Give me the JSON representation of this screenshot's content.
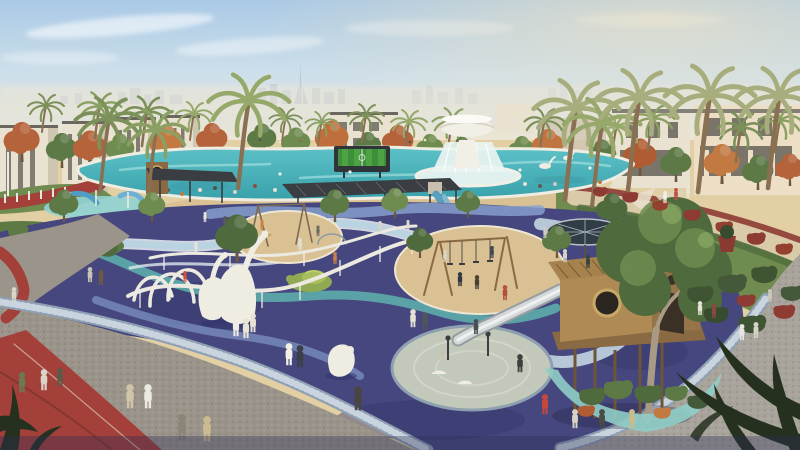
{
  "meta": {
    "kind": "architectural-rendering",
    "label": "Aerial rendering of a landscaped community park with playground, lagoon pool and fountain"
  },
  "labels": {
    "scene": "Community park rendering",
    "sky": "Hazy warm sky with wispy clouds",
    "skyline": "Distant hazy city skyline",
    "tower": "Burj Khalifa silhouette",
    "villas_left": "White townhouse villas, left row",
    "villas_right": "Cream villa facades, right row",
    "fountain": "White tulip fountain with cascading water",
    "pool": "Lagoon swimming pool",
    "screen": "Outdoor video screen showing green sports field",
    "splash": "Kids aqua splash area with blue slides",
    "plaza": "Granite cobble plaza",
    "track": "Red running track",
    "playground": "Indigo rubber playground surface with wavy ribbons",
    "swans": "White swan play sculptures with looping rails",
    "sand_small": "Sand play circle with climbing frames",
    "sand_large": "Sand play area with swing sets",
    "pergola_left": "Dark shade canopy with porthole tower",
    "pergola_center": "Long shade pergola",
    "umbrella": "Large ribbed shade umbrella",
    "pad": "Pale circular play pad",
    "slide": "Gray slide from treehouse",
    "treehouse": "Wooden treehouse on stilts with porthole",
    "tree_big": "Large tree growing through treehouse",
    "crescent": "Teal crescent path around planting island",
    "cobble_right": "Curved cobblestone promenade",
    "walkway": "Curved walkway with red flower hedge",
    "bear": "White bear play sculpture",
    "turtle": "Green turtle play mound",
    "palm_silhouette": "Dark palm fronds in foreground corner",
    "people": "Park visitors",
    "palms": "Palm trees"
  },
  "palette": {
    "sky_top": "#a9c9e6",
    "sky_mid": "#cfe0ea",
    "horizon": "#ece5d4",
    "glow": "#f6e3bd",
    "skyline": "#b6c2d0",
    "bldg_light": "#e9e2d1",
    "bldg_shade": "#cfc6b2",
    "bldg_dark": "#55514a",
    "tree_green": "#5d7a46",
    "tree_green2": "#6f8c50",
    "tree_dark": "#4f6a3c",
    "orange": "#b5633a",
    "orange2": "#c27a42",
    "palm": "#7c915a",
    "palm2": "#96a86a",
    "palm3": "#a8ad7e",
    "pool": "#5cc0c6",
    "pool_deep": "#3aa2ac",
    "water_light": "#dff0ee",
    "fountain": "#f2efe6",
    "sand": "#d9c194",
    "sand_light": "#e2cfa4",
    "walk": "#d9cba8",
    "lawn": "#6f8b4f",
    "lawn_dark": "#5e7a44",
    "plaza": "#9b948a",
    "cobble": "#a8a49c",
    "mosaic": "#8fa0b4",
    "mosaic_light": "#c9d4de",
    "track": "#a3403a",
    "track_dark": "#7e332e",
    "play": "#45477e",
    "play_dark": "#32356a",
    "play_deep": "#2c2f55",
    "ribbon_pale": "#c2d6e2",
    "ribbon_teal": "#5fb3ae",
    "ribbon_peri": "#8aa4cf",
    "ribbon_light": "#b9d4e0",
    "wood": "#b08a55",
    "wood_dark": "#8a6a42",
    "wood_deep": "#6e5536",
    "pad": "#c2c9ba",
    "crescent": "#8fcdc7",
    "slide": "#d4d8d9",
    "struct": "#3a3e42",
    "silhouette": "#26301f",
    "white": "#efece2",
    "hedge": "#8e3b34",
    "hedge_green": "#516d3d",
    "screen_green": "#3f8f3a"
  },
  "sprites": {
    "palms": [
      [
        42,
        132,
        1.0,
        "#7c915a"
      ],
      [
        95,
        138,
        1.2,
        "#8aa062"
      ],
      [
        142,
        146,
        1.3,
        "#7c915a"
      ],
      [
        190,
        140,
        1.0,
        "#96a86a"
      ],
      [
        282,
        142,
        0.9,
        "#7c915a"
      ],
      [
        318,
        146,
        0.9,
        "#8aa062"
      ],
      [
        362,
        142,
        1.0,
        "#7c915a"
      ],
      [
        405,
        148,
        1.0,
        "#96a86a"
      ],
      [
        448,
        150,
        1.1,
        "#8aa062"
      ],
      [
        540,
        150,
        1.1,
        "#7c915a"
      ],
      [
        612,
        156,
        1.1,
        "#96a86a"
      ],
      [
        648,
        150,
        1.2,
        "#8aa062"
      ],
      [
        736,
        162,
        1.3,
        "#7c915a"
      ],
      [
        775,
        152,
        1.2,
        "#8aa062"
      ]
    ],
    "palmsTall": [
      [
        100,
        192,
        1.5,
        "#7c915a"
      ],
      [
        148,
        198,
        1.4,
        "#8aa062"
      ],
      [
        238,
        188,
        1.8,
        "#96a86a"
      ],
      [
        565,
        200,
        1.9,
        "#a8ad7e"
      ],
      [
        592,
        206,
        1.7,
        "#96a86a"
      ],
      [
        628,
        190,
        1.9,
        "#a8ad7e"
      ],
      [
        698,
        192,
        2.0,
        "#a8ad7e"
      ],
      [
        768,
        188,
        1.9,
        "#a8ad7e"
      ]
    ],
    "trees": [
      [
        22,
        162,
        1.6,
        "#b5633a"
      ],
      [
        62,
        168,
        1.4,
        "#5d7a46"
      ],
      [
        90,
        168,
        1.5,
        "#b5633a"
      ],
      [
        120,
        166,
        1.3,
        "#6f8c50"
      ],
      [
        166,
        162,
        1.5,
        "#c27a42"
      ],
      [
        212,
        158,
        1.4,
        "#b5633a"
      ],
      [
        262,
        156,
        1.3,
        "#5d7a46"
      ],
      [
        296,
        160,
        1.3,
        "#6f8c50"
      ],
      [
        332,
        158,
        1.5,
        "#bf6f3c"
      ],
      [
        368,
        162,
        1.2,
        "#5d7a46"
      ],
      [
        398,
        160,
        1.4,
        "#b5633a"
      ],
      [
        430,
        164,
        1.2,
        "#6f8c50"
      ],
      [
        462,
        164,
        1.1,
        "#5d7a46"
      ],
      [
        522,
        166,
        1.2,
        "#6f8c50"
      ],
      [
        548,
        164,
        1.4,
        "#c07440"
      ],
      [
        602,
        172,
        1.3,
        "#5d7a46"
      ],
      [
        640,
        176,
        1.5,
        "#b05c32"
      ],
      [
        676,
        182,
        1.4,
        "#5d7a46"
      ],
      [
        722,
        184,
        1.6,
        "#c27a42"
      ],
      [
        758,
        190,
        1.4,
        "#5d7a46"
      ],
      [
        790,
        186,
        1.3,
        "#b5633a"
      ]
    ],
    "trees2": [
      [
        64,
        222,
        1.3,
        "#5d7a46"
      ],
      [
        152,
        222,
        1.2,
        "#6f8c50"
      ],
      [
        237,
        262,
        1.9,
        "#4f6a3c"
      ],
      [
        335,
        222,
        1.3,
        "#5d7a46"
      ],
      [
        395,
        218,
        1.2,
        "#6f8c50"
      ],
      [
        468,
        218,
        1.1,
        "#5d7a46"
      ],
      [
        420,
        258,
        1.2,
        "#4f6a3c"
      ],
      [
        557,
        258,
        1.3,
        "#5d7a46"
      ],
      [
        612,
        228,
        1.4,
        "#4f6a3c"
      ],
      [
        650,
        244,
        1.3,
        "#5d7a46"
      ]
    ],
    "bushes2": [
      [
        18,
        238,
        1.4,
        "#5e7a44"
      ],
      [
        48,
        244,
        1.5,
        "#54713e"
      ],
      [
        78,
        250,
        1.4,
        "#5e7a44"
      ],
      [
        108,
        256,
        1.3,
        "#4f6a3c"
      ],
      [
        600,
        196,
        1.0,
        "#8e3b34"
      ],
      [
        630,
        202,
        1.1,
        "#8e3b34"
      ],
      [
        660,
        210,
        1.1,
        "#93402f"
      ],
      [
        692,
        220,
        1.2,
        "#8e3b34"
      ],
      [
        724,
        232,
        1.2,
        "#93402f"
      ],
      [
        756,
        244,
        1.3,
        "#8e3b34"
      ],
      [
        784,
        254,
        1.2,
        "#93402f"
      ],
      [
        700,
        302,
        1.8,
        "#3f5433"
      ],
      [
        732,
        292,
        2.0,
        "#44593a"
      ],
      [
        764,
        282,
        1.8,
        "#3f5433"
      ],
      [
        792,
        300,
        1.6,
        "#44593a"
      ],
      [
        716,
        322,
        1.7,
        "#374b2e"
      ],
      [
        752,
        332,
        1.9,
        "#3f5433"
      ],
      [
        784,
        318,
        1.5,
        "#8e3b34"
      ],
      [
        746,
        306,
        1.3,
        "#8e3b34"
      ],
      [
        592,
        404,
        1.8,
        "#4f6a3c"
      ],
      [
        618,
        398,
        2.0,
        "#5d7a46"
      ],
      [
        648,
        402,
        1.9,
        "#4f6a3c"
      ],
      [
        676,
        400,
        1.6,
        "#5d7a46"
      ],
      [
        698,
        408,
        1.5,
        "#44593a"
      ],
      [
        586,
        416,
        1.2,
        "#b05c32"
      ],
      [
        662,
        418,
        1.2,
        "#c27a42"
      ]
    ],
    "people": [
      [
        130,
        408,
        2.4,
        "#cfc4a8"
      ],
      [
        148,
        408,
        2.4,
        "#eceadf"
      ],
      [
        182,
        440,
        2.6,
        "#8b8577"
      ],
      [
        207,
        441,
        2.5,
        "#cabb90"
      ],
      [
        22,
        392,
        2.0,
        "#6a7a52"
      ],
      [
        44,
        390,
        2.1,
        "#d9d5c9"
      ],
      [
        60,
        386,
        1.8,
        "#5a5a48"
      ],
      [
        236,
        336,
        2.0,
        "#f0ece2"
      ],
      [
        246,
        338,
        2.0,
        "#e9e4d4"
      ],
      [
        253,
        332,
        1.9,
        "#e6e2d4"
      ],
      [
        289,
        365,
        2.2,
        "#f2efe6"
      ],
      [
        300,
        367,
        2.2,
        "#3c4046"
      ],
      [
        358,
        410,
        2.4,
        "#4a4540"
      ],
      [
        413,
        327,
        1.8,
        "#e4e0d4"
      ],
      [
        425,
        330,
        1.8,
        "#50555c"
      ],
      [
        90,
        282,
        1.5,
        "#c9c4b4"
      ],
      [
        101,
        285,
        1.5,
        "#6e5a44"
      ],
      [
        14,
        302,
        1.5,
        "#d9d5c9"
      ],
      [
        545,
        414,
        2.0,
        "#c4483e"
      ],
      [
        575,
        428,
        1.9,
        "#d8d2c4"
      ],
      [
        602,
        428,
        1.9,
        "#4a4e42"
      ],
      [
        632,
        428,
        1.9,
        "#c9bb8a"
      ],
      [
        520,
        372,
        1.8,
        "#3f3f3c"
      ],
      [
        476,
        334,
        1.5,
        "#4a4e52"
      ],
      [
        443,
        360,
        1.5,
        "#c9c4b4"
      ],
      [
        460,
        286,
        1.4,
        "#33383e"
      ],
      [
        477,
        289,
        1.4,
        "#4a3f35"
      ],
      [
        505,
        300,
        1.5,
        "#b45040"
      ],
      [
        445,
        262,
        1.2,
        "#d9d5c9"
      ],
      [
        492,
        258,
        1.2,
        "#44484e"
      ],
      [
        335,
        264,
        1.2,
        "#c97f4a"
      ],
      [
        300,
        250,
        1.2,
        "#e2ded2"
      ],
      [
        318,
        236,
        1.05,
        "#6a6e62"
      ],
      [
        262,
        230,
        1.0,
        "#c9803f"
      ],
      [
        205,
        222,
        1.0,
        "#e8e4d8"
      ],
      [
        225,
        226,
        1.0,
        "#5a5e52"
      ],
      [
        380,
        232,
        1.1,
        "#d8d4c8"
      ],
      [
        408,
        230,
        1.0,
        "#e0dcd0"
      ],
      [
        545,
        238,
        1.1,
        "#d0ccc0"
      ],
      [
        665,
        203,
        1.2,
        "#f0ede4"
      ],
      [
        676,
        200,
        1.2,
        "#c05048"
      ],
      [
        688,
        198,
        1.2,
        "#e8e4d8"
      ],
      [
        742,
        340,
        1.6,
        "#e8e6df"
      ],
      [
        756,
        338,
        1.6,
        "#d6d2c6"
      ],
      [
        770,
        302,
        1.3,
        "#ccc8ba"
      ],
      [
        700,
        315,
        1.4,
        "#e6e2d6"
      ],
      [
        714,
        318,
        1.4,
        "#8a4a40"
      ],
      [
        185,
        282,
        1.1,
        "#d94f42"
      ],
      [
        196,
        252,
        1.0,
        "#e8e4da"
      ],
      [
        565,
        262,
        1.3,
        "#d8d4c8"
      ],
      [
        588,
        268,
        1.3,
        "#3e423f"
      ]
    ],
    "dots": [
      [
        155,
        192,
        2,
        "#d9d3c5"
      ],
      [
        168,
        190,
        2,
        "#6a5f4e"
      ],
      [
        182,
        194,
        2,
        "#c27a45"
      ],
      [
        200,
        190,
        2,
        "#e6e0d2"
      ],
      [
        215,
        188,
        2,
        "#55504a"
      ],
      [
        235,
        192,
        2,
        "#d9d3c5"
      ],
      [
        255,
        186,
        2,
        "#8a4f3c"
      ],
      [
        275,
        190,
        2,
        "#e6e0d2"
      ],
      [
        300,
        188,
        2,
        "#5f5a50"
      ],
      [
        320,
        190,
        2,
        "#d0c9ba"
      ],
      [
        345,
        186,
        2,
        "#b5433a"
      ],
      [
        365,
        188,
        2,
        "#e6e0d2"
      ],
      [
        395,
        186,
        2,
        "#6a6456"
      ],
      [
        415,
        188,
        2,
        "#d9d3c5"
      ],
      [
        435,
        190,
        2,
        "#8a8172"
      ],
      [
        525,
        184,
        2,
        "#e6e0d2"
      ],
      [
        540,
        186,
        2,
        "#5f5a50"
      ],
      [
        555,
        184,
        2,
        "#d0c9ba"
      ],
      [
        600,
        182,
        2,
        "#c27a45"
      ],
      [
        612,
        186,
        2,
        "#e6e0d2"
      ],
      [
        520,
        170,
        1.6,
        "#e8f0ee"
      ],
      [
        350,
        172,
        1.6,
        "#eef4f2"
      ],
      [
        280,
        174,
        1.6,
        "#e8f0ee"
      ],
      [
        240,
        172,
        1.6,
        "#dfeeec"
      ],
      [
        450,
        172,
        1.6,
        "#e8f0ee"
      ],
      [
        590,
        168,
        1.6,
        "#eef2f0"
      ],
      [
        260,
        140,
        1.4,
        "#5a564e"
      ],
      [
        280,
        142,
        1.4,
        "#e6e0d2"
      ],
      [
        300,
        141,
        1.4,
        "#8a6a4e"
      ],
      [
        410,
        142,
        1.4,
        "#5a564e"
      ],
      [
        425,
        140,
        1.4,
        "#e6e0d2"
      ]
    ]
  }
}
